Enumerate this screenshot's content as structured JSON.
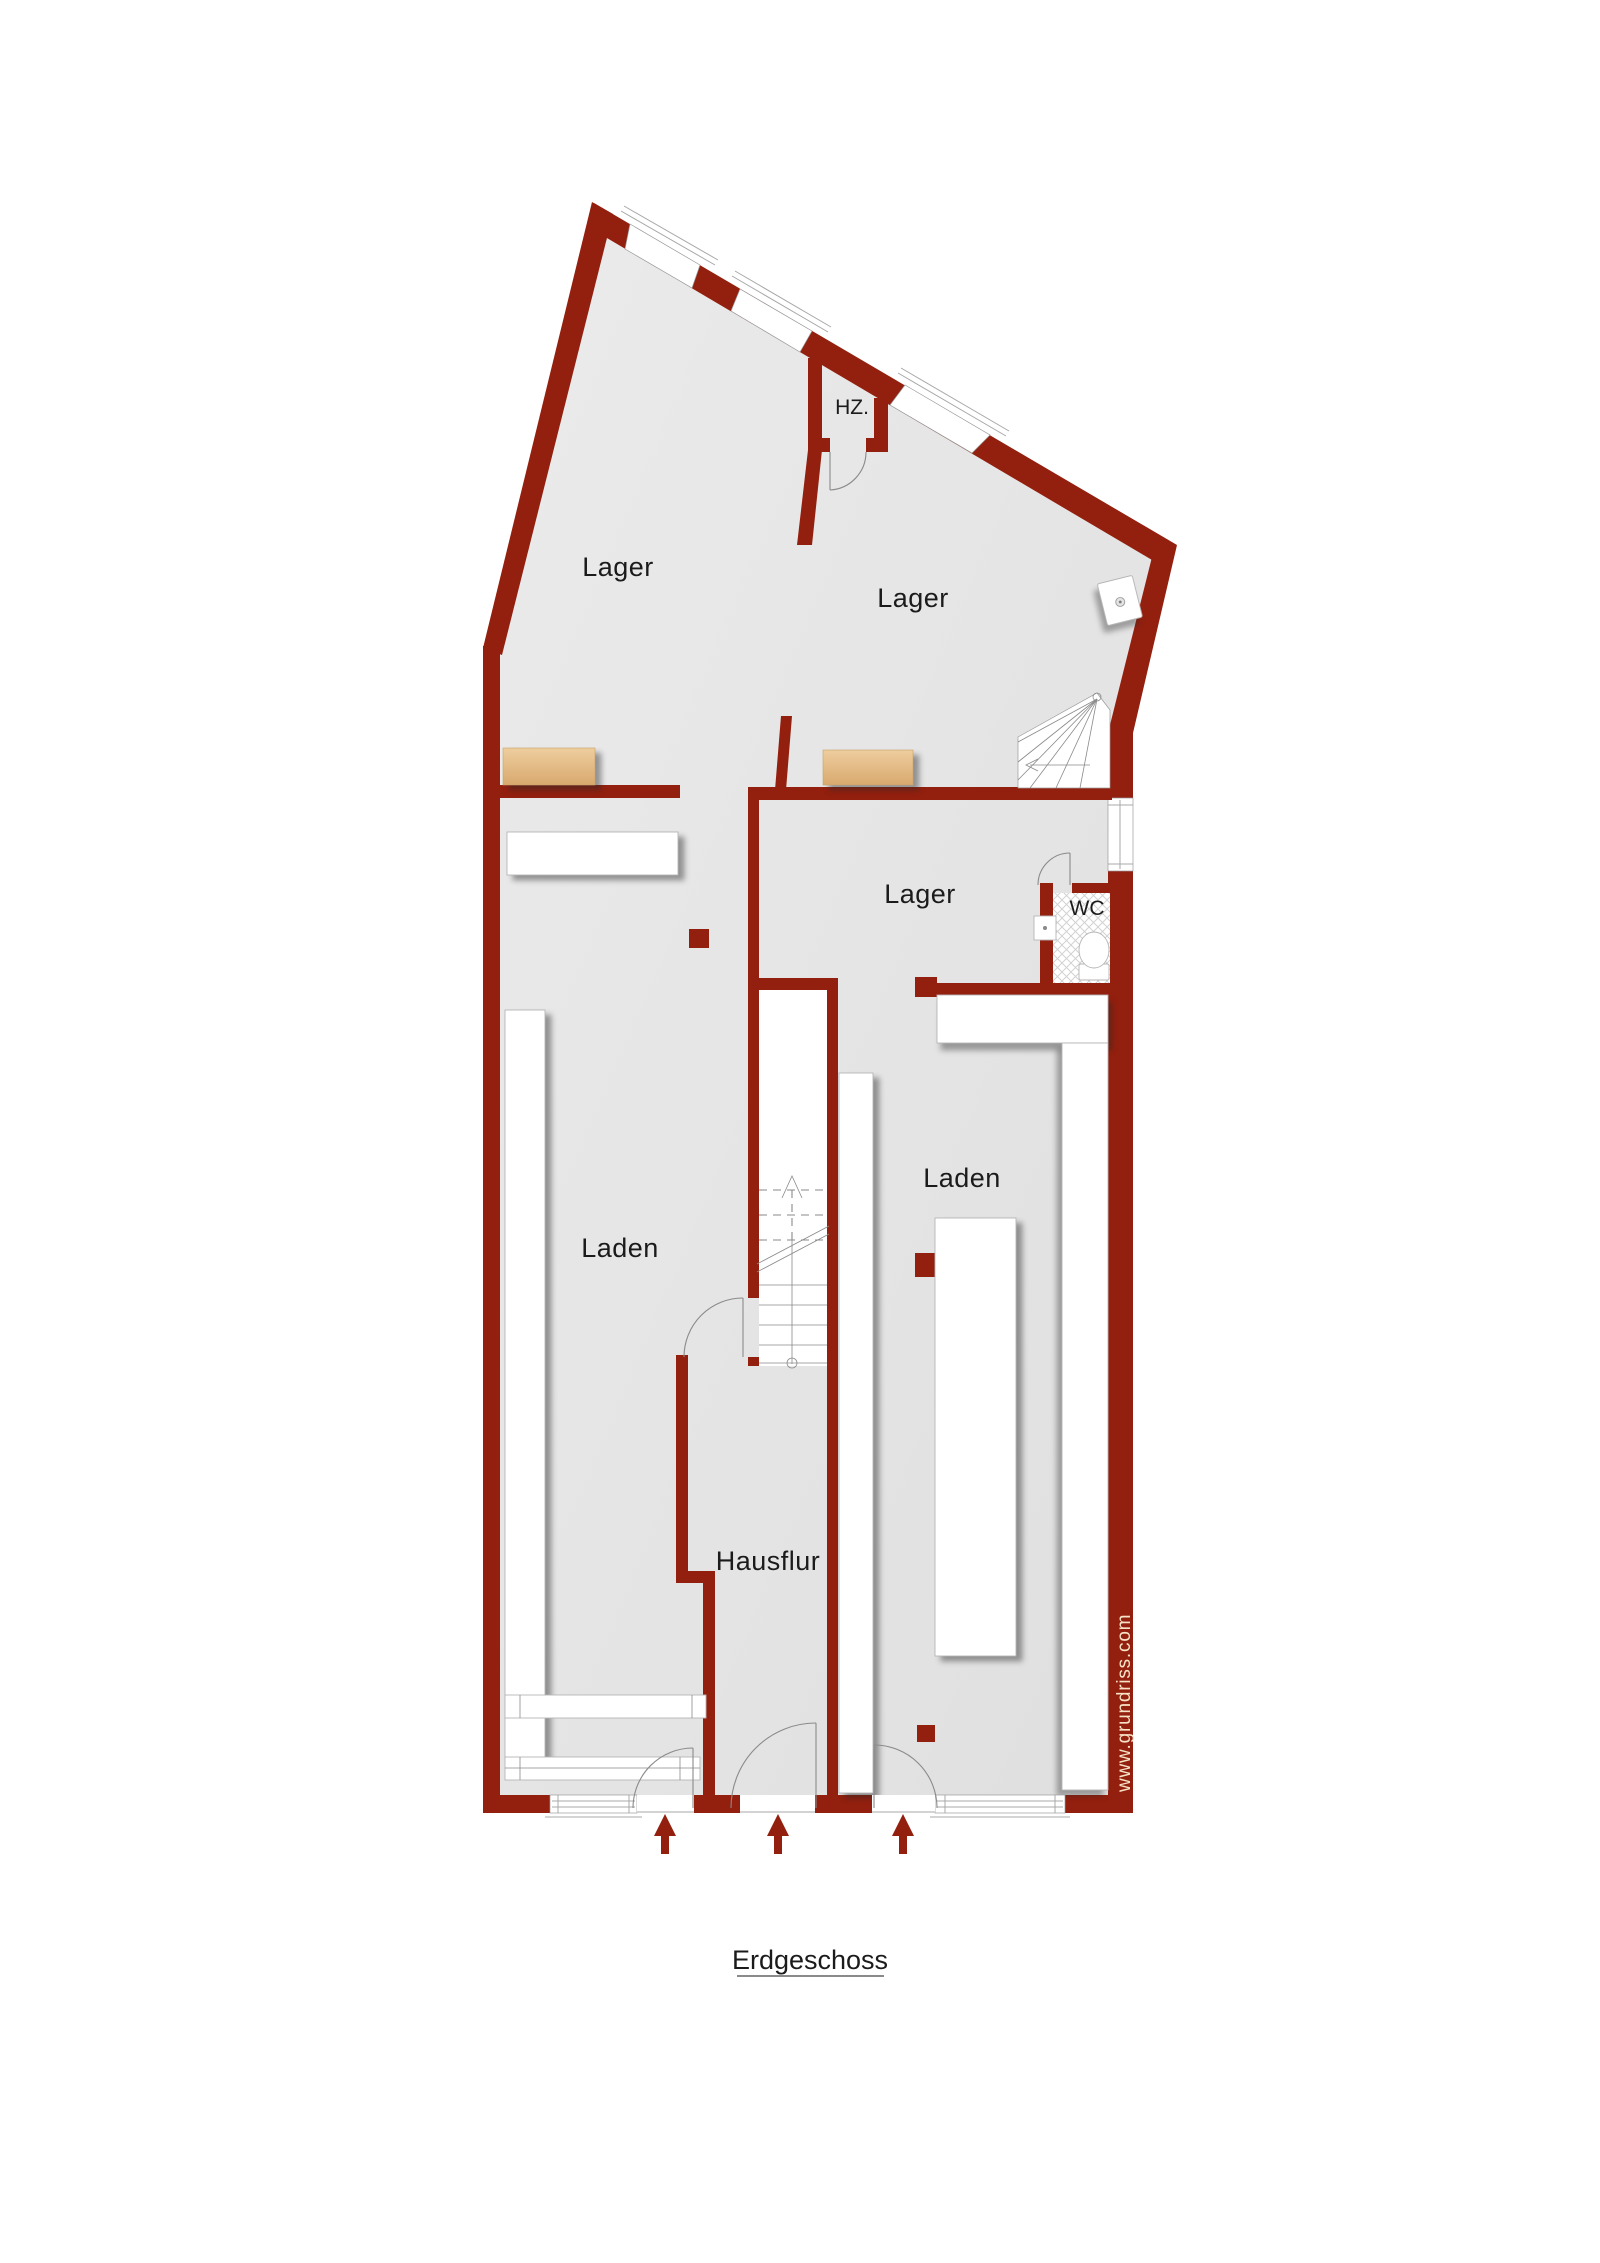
{
  "title": "Erdgeschoss",
  "watermark": "www.grundriss.com",
  "rooms": {
    "lager_top_left": {
      "label": "Lager"
    },
    "lager_top_right": {
      "label": "Lager"
    },
    "lager_middle": {
      "label": "Lager"
    },
    "hz": {
      "label": "HZ."
    },
    "wc": {
      "label": "WC"
    },
    "laden_left": {
      "label": "Laden"
    },
    "laden_right": {
      "label": "Laden"
    },
    "hausflur": {
      "label": "Hausflur"
    }
  },
  "entrances": {
    "count": 3
  },
  "fixtures": [
    "main-staircase",
    "winder-staircase",
    "toilet",
    "wc-sink",
    "lager-sink",
    "bench",
    "shelf",
    "counter",
    "entrance-arrow"
  ],
  "colors": {
    "wall": "#931f0e",
    "floor": "#e4e4e4",
    "floor_light": "#ebebeb",
    "furniture": "#ffffff",
    "furniture_outline": "#b5b5b5",
    "bench": "#eac795",
    "bench_dark": "#d8a96e",
    "thin_line": "#8a8a8a",
    "label_text": "#1b1b1b",
    "watermark_text": "#f6e2c6",
    "page": "#ffffff"
  }
}
